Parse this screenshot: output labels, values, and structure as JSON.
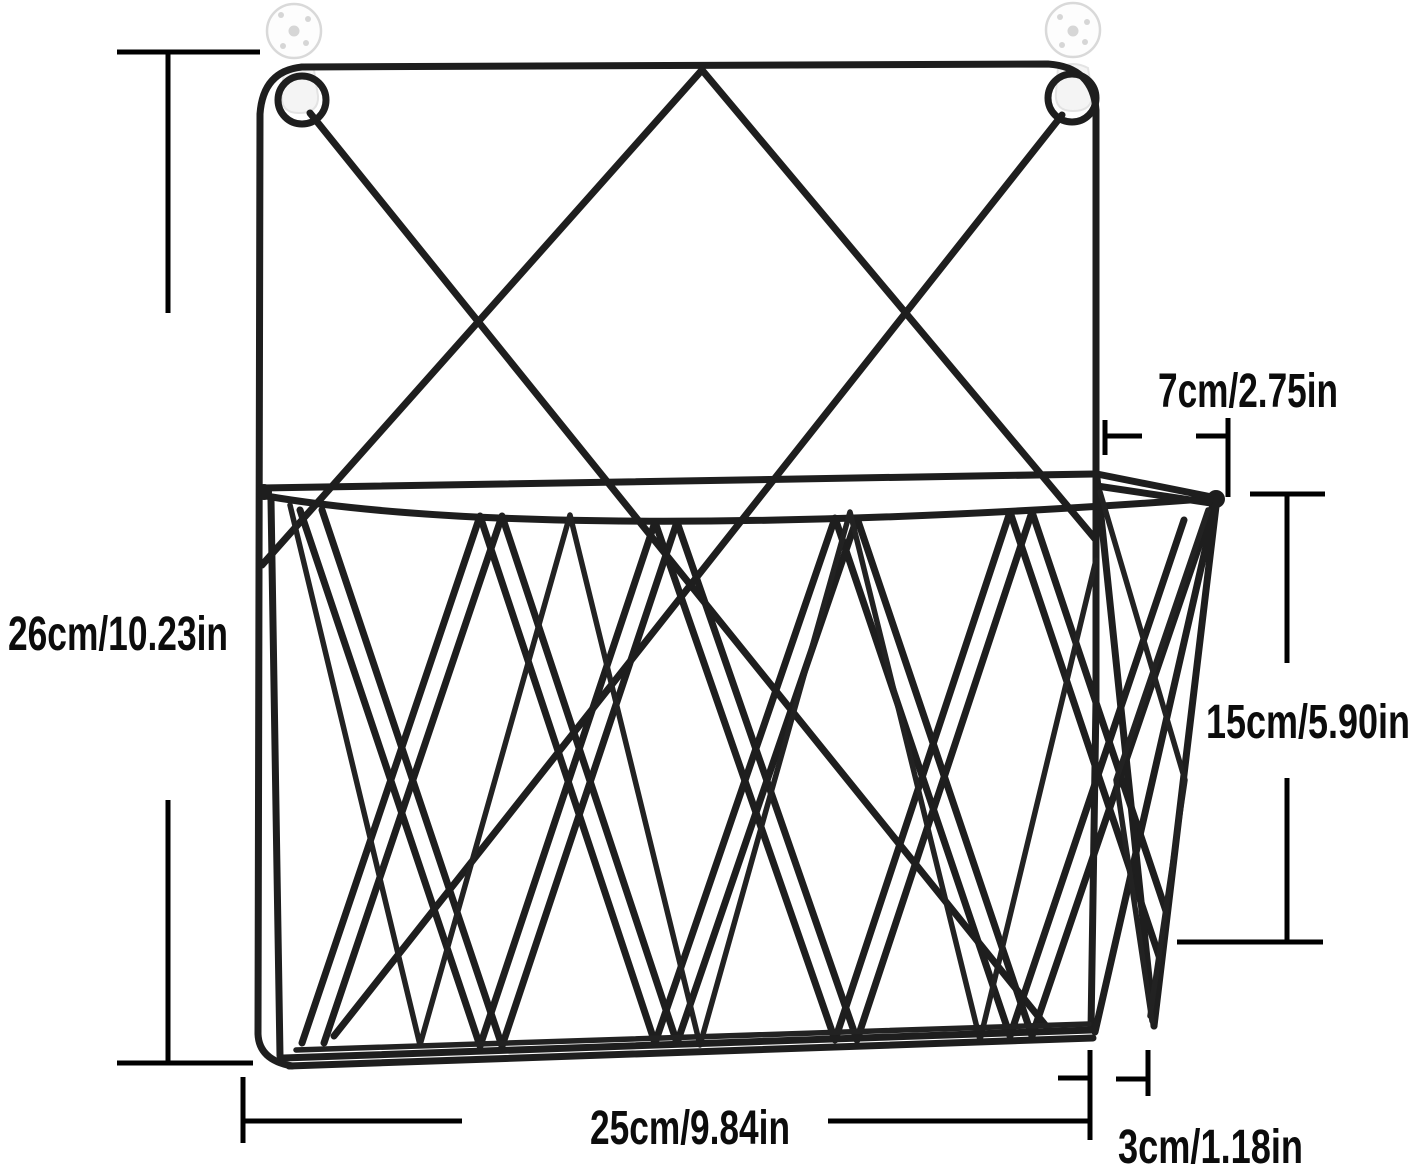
{
  "diagram": {
    "title": "wall-mounted wire magazine rack with dimension annotations",
    "background_color": "#ffffff",
    "wire_color": "#1e1e1e",
    "dimension_color": "#000000",
    "anchor_color": "#fdfdfd",
    "dimensions": {
      "total_height": {
        "label": "26cm/10.23in",
        "cm": 26,
        "inches": 10.23,
        "side": "left"
      },
      "top_depth": {
        "label": "7cm/2.75in",
        "cm": 7,
        "inches": 2.75,
        "side": "top-right"
      },
      "pocket_height": {
        "label": "15cm/5.90in",
        "cm": 15,
        "inches": 5.9,
        "side": "right"
      },
      "width": {
        "label": "25cm/9.84in",
        "cm": 25,
        "inches": 9.84,
        "side": "bottom"
      },
      "bottom_depth": {
        "label": "3cm/1.18in",
        "cm": 3,
        "inches": 1.18,
        "side": "bottom-right"
      }
    }
  }
}
